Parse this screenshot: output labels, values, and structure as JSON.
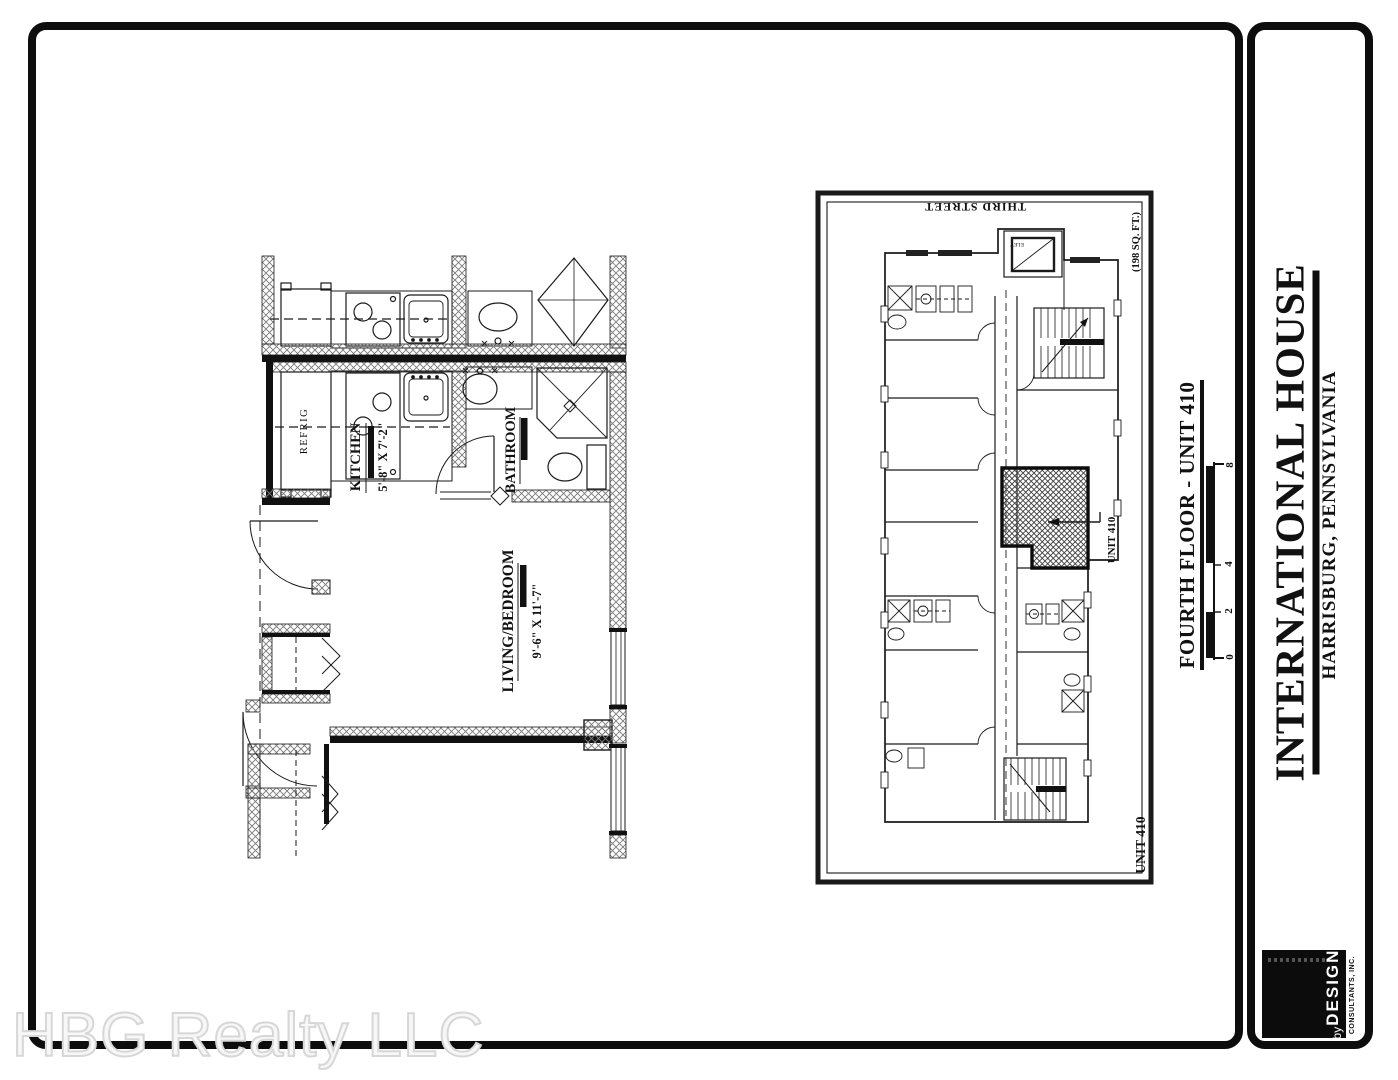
{
  "watermark": {
    "text": "HBG Realty LLC"
  },
  "sheet": {
    "unit_plan": {
      "refrig": "REFRIG",
      "kitchen": "KITCHEN",
      "kitchen_dims": "5'-8\" X 7'-2\"",
      "bathroom": "BATHROOM",
      "living": "LIVING/BEDROOM",
      "living_dims": "9'-6\" X 11'-7\""
    },
    "overview": {
      "street": "THIRD STREET",
      "area": "(198 SQ. FT.)",
      "elevator": "ELEV",
      "unit_callout": "UNIT 410",
      "unit_corner": "UNIT 410"
    },
    "title_block": {
      "title": "FOURTH FLOOR - UNIT 410",
      "scale": {
        "t0": "0",
        "t2": "2",
        "t4": "4",
        "t8": "8"
      }
    }
  },
  "panel": {
    "project": "INTERNATIONAL HOUSE",
    "location": "HARRISBURG, PENNSYLVANIA",
    "logo": {
      "by": "by",
      "name": "DESIGN",
      "firm": "CONSULTANTS, INC."
    }
  },
  "colors": {
    "ink": "#111111",
    "paper": "#ffffff",
    "watermark": "#e9e9e9"
  }
}
